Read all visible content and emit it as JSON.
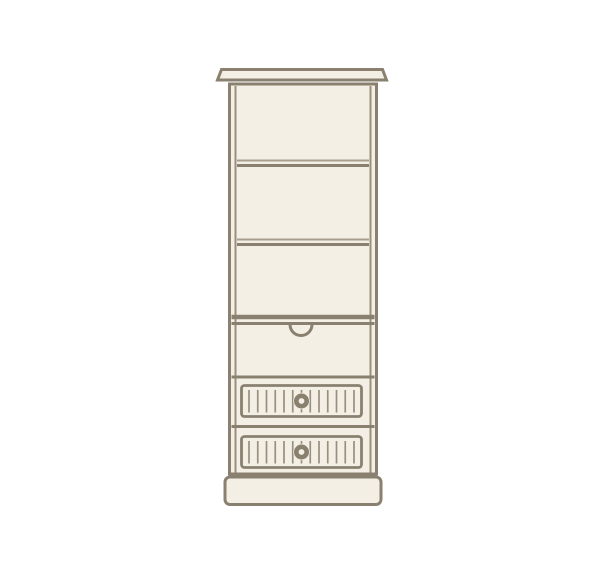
{
  "meta": {
    "description": "Line illustration of a tall cream-painted bookcase cabinet: cornice top, three open shelf compartments, a pull-out section with an arched finger cut-out, two tongue-and-groove drawers with round knobs, and a plinth base."
  },
  "palette": {
    "background": "#ffffff",
    "outline": "#89806f",
    "line_light": "#a79e8e",
    "slat": "#998f7e",
    "fill": "#f4efe5"
  },
  "furniture": {
    "type": "tall-bookcase-with-drawers",
    "parts": [
      {
        "name": "cornice-top"
      },
      {
        "name": "open-shelving",
        "shelves": 2,
        "compartments": 3
      },
      {
        "name": "pull-out-panel",
        "handle": "arched-finger-cutout"
      },
      {
        "name": "drawer-upper",
        "front": "tongue-and-groove",
        "knob": "round-knob"
      },
      {
        "name": "drawer-lower",
        "front": "tongue-and-groove",
        "knob": "round-knob"
      },
      {
        "name": "plinth-base"
      }
    ],
    "drawing": {
      "drawer_count": 2,
      "shelf_count": 2,
      "slats_per_drawer": 13
    }
  }
}
